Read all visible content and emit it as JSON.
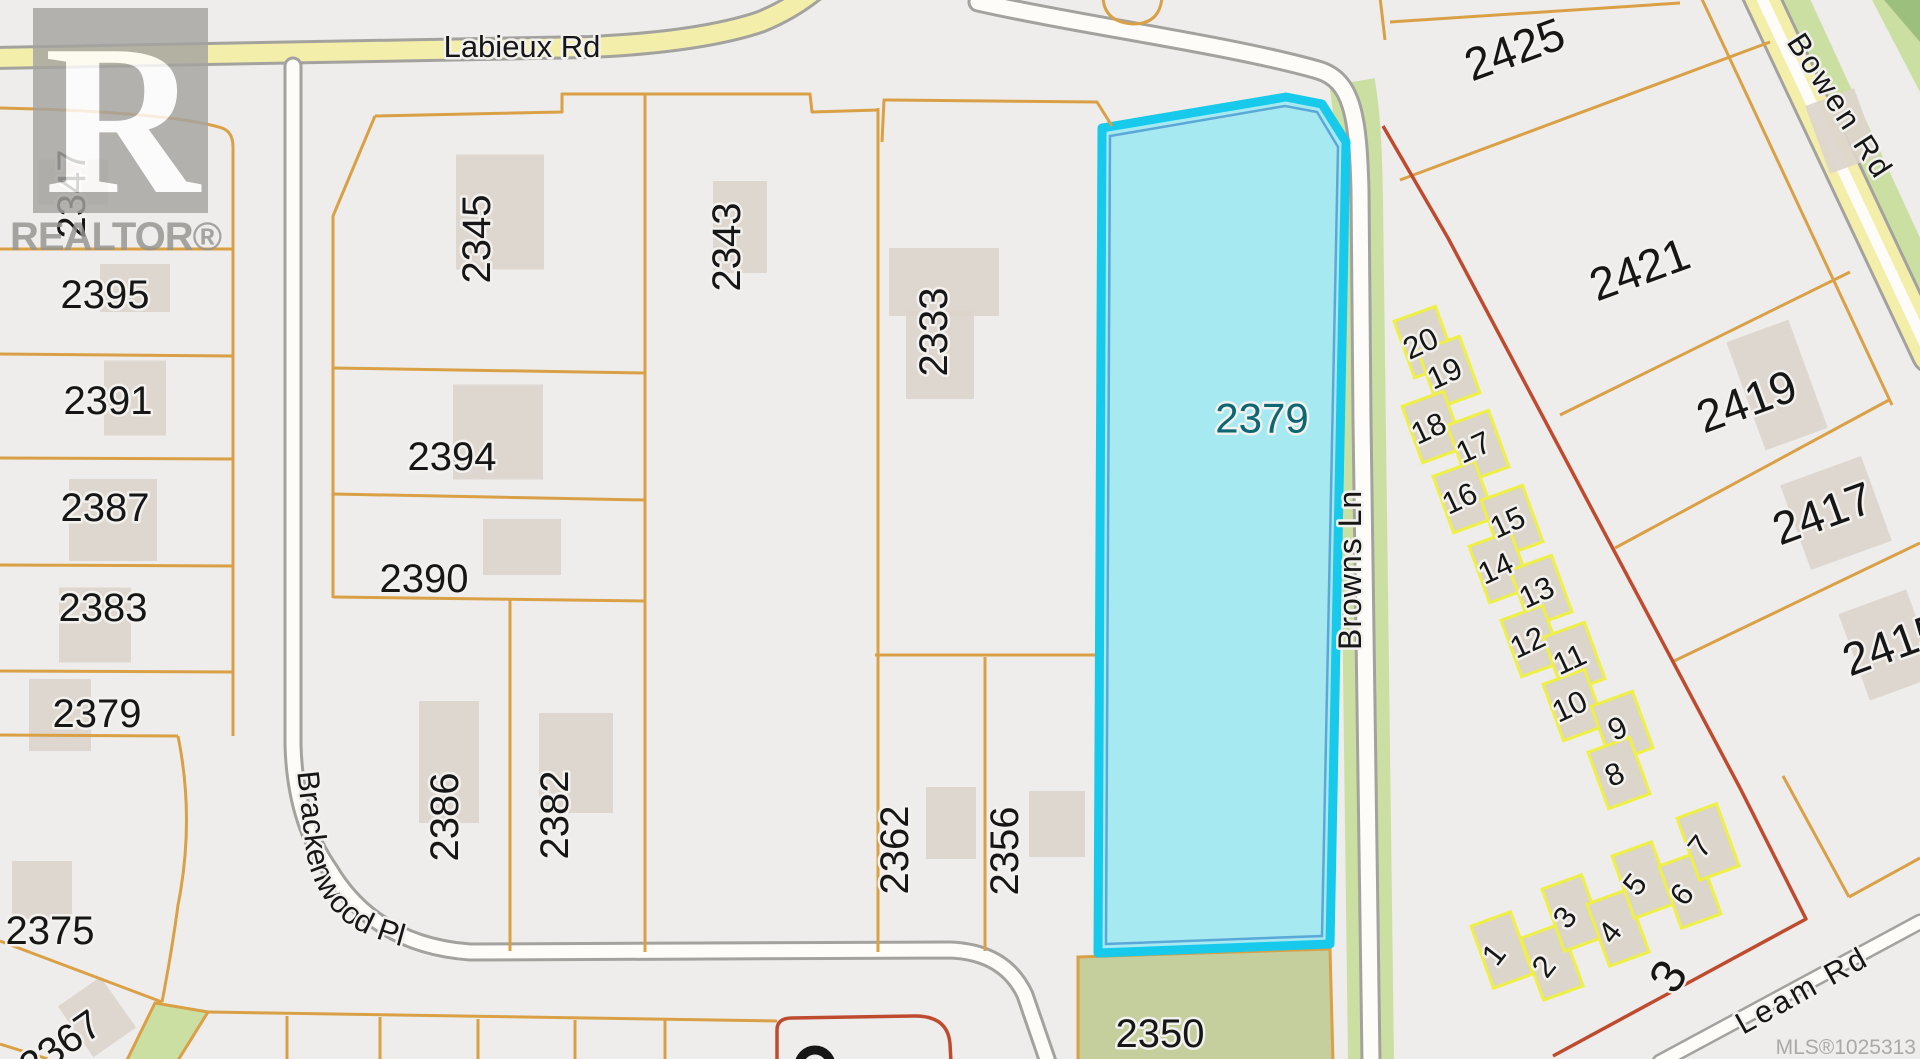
{
  "watermark": {
    "logo_letter": "R",
    "brand": "REALTOR®"
  },
  "mls_number": "MLS®1025313",
  "roads": {
    "labieux": {
      "label": "Labieux Rd"
    },
    "brackenwood": {
      "label": "Brackenwood Pl"
    },
    "browns": {
      "label": "Browns Ln"
    },
    "bowen": {
      "label": "Bowen Rd"
    },
    "leam": {
      "label": "Leam Rd"
    }
  },
  "highlight_parcel": {
    "number": "2379",
    "label_color": "#0c6773"
  },
  "parcel_labels": [
    {
      "t": "2347",
      "x": 85,
      "y": 180,
      "r": -90,
      "s": 40
    },
    {
      "t": "2395",
      "x": 105,
      "y": 294,
      "r": 0,
      "s": 40
    },
    {
      "t": "2391",
      "x": 108,
      "y": 400,
      "r": 0,
      "s": 40
    },
    {
      "t": "2387",
      "x": 105,
      "y": 507,
      "r": 0,
      "s": 40
    },
    {
      "t": "2383",
      "x": 103,
      "y": 607,
      "r": 0,
      "s": 40
    },
    {
      "t": "2379",
      "x": 97,
      "y": 713,
      "r": 0,
      "s": 40
    },
    {
      "t": "2375",
      "x": 50,
      "y": 930,
      "r": 0,
      "s": 40
    },
    {
      "t": "2367",
      "x": 68,
      "y": 1042,
      "r": -35,
      "s": 40
    },
    {
      "t": "2345",
      "x": 490,
      "y": 225,
      "r": -90,
      "s": 40
    },
    {
      "t": "2394",
      "x": 452,
      "y": 456,
      "r": 0,
      "s": 40
    },
    {
      "t": "2390",
      "x": 424,
      "y": 578,
      "r": 0,
      "s": 40
    },
    {
      "t": "2386",
      "x": 458,
      "y": 803,
      "r": -90,
      "s": 40
    },
    {
      "t": "2382",
      "x": 568,
      "y": 801,
      "r": -90,
      "s": 40
    },
    {
      "t": "2343",
      "x": 740,
      "y": 233,
      "r": -90,
      "s": 40
    },
    {
      "t": "2333",
      "x": 947,
      "y": 318,
      "r": -90,
      "s": 40
    },
    {
      "t": "2362",
      "x": 908,
      "y": 836,
      "r": -90,
      "s": 40
    },
    {
      "t": "2356",
      "x": 1018,
      "y": 837,
      "r": -90,
      "s": 40
    },
    {
      "t": "2379",
      "x": 1262,
      "y": 418,
      "r": 0,
      "s": 42,
      "c": "#0c6773"
    },
    {
      "t": "2350",
      "x": 1160,
      "y": 1033,
      "r": 0,
      "s": 40
    },
    {
      "t": "2425",
      "x": 1520,
      "y": 48,
      "r": -20,
      "s": 46
    },
    {
      "t": "2421",
      "x": 1645,
      "y": 268,
      "r": -20,
      "s": 46
    },
    {
      "t": "2419",
      "x": 1752,
      "y": 400,
      "r": -20,
      "s": 46
    },
    {
      "t": "2417",
      "x": 1828,
      "y": 512,
      "r": -20,
      "s": 46
    },
    {
      "t": "2415",
      "x": 1898,
      "y": 643,
      "r": -20,
      "s": 46
    },
    {
      "t": "3",
      "x": 1682,
      "y": 968,
      "r": -58,
      "s": 48
    }
  ],
  "lot_groups": [
    {
      "name": "townhouse-upper-row",
      "w": 44,
      "h": 60,
      "unit_rot": -20,
      "num_rot": -25,
      "num_size": 31,
      "lots": [
        {
          "n": "20",
          "x": 1425,
          "y": 342
        },
        {
          "n": "19",
          "x": 1449,
          "y": 372
        },
        {
          "n": "18",
          "x": 1433,
          "y": 427
        },
        {
          "n": "17",
          "x": 1478,
          "y": 446
        },
        {
          "n": "16",
          "x": 1464,
          "y": 497
        },
        {
          "n": "15",
          "x": 1512,
          "y": 521
        },
        {
          "n": "14",
          "x": 1500,
          "y": 567
        },
        {
          "n": "13",
          "x": 1541,
          "y": 591
        },
        {
          "n": "12",
          "x": 1532,
          "y": 641
        },
        {
          "n": "11",
          "x": 1574,
          "y": 658
        },
        {
          "n": "10",
          "x": 1574,
          "y": 705
        },
        {
          "n": "9",
          "x": 1622,
          "y": 727
        },
        {
          "n": "8",
          "x": 1619,
          "y": 773
        }
      ]
    },
    {
      "name": "townhouse-lower-row",
      "w": 42,
      "h": 66,
      "unit_rot": -20,
      "num_rot": -52,
      "num_size": 31,
      "lots": [
        {
          "n": "1",
          "x": 1502,
          "y": 950
        },
        {
          "n": "2",
          "x": 1552,
          "y": 962
        },
        {
          "n": "3",
          "x": 1573,
          "y": 913
        },
        {
          "n": "4",
          "x": 1618,
          "y": 928
        },
        {
          "n": "5",
          "x": 1643,
          "y": 880
        },
        {
          "n": "6",
          "x": 1690,
          "y": 890
        },
        {
          "n": "7",
          "x": 1708,
          "y": 842
        }
      ]
    }
  ],
  "buildings": [
    [
      73,
      182,
      70,
      45,
      0
    ],
    [
      135,
      288,
      70,
      48,
      0
    ],
    [
      135,
      398,
      62,
      75,
      0
    ],
    [
      113,
      520,
      88,
      82,
      0
    ],
    [
      95,
      625,
      72,
      75,
      0
    ],
    [
      60,
      715,
      62,
      72,
      0
    ],
    [
      42,
      890,
      60,
      58,
      0
    ],
    [
      97,
      1017,
      52,
      62,
      -35
    ],
    [
      500,
      212,
      88,
      115,
      0
    ],
    [
      498,
      432,
      90,
      95,
      0
    ],
    [
      522,
      547,
      78,
      56,
      0
    ],
    [
      449,
      762,
      60,
      122,
      0
    ],
    [
      576,
      763,
      74,
      100,
      0
    ],
    [
      740,
      227,
      54,
      92,
      0
    ],
    [
      944,
      282,
      110,
      68,
      0
    ],
    [
      940,
      355,
      68,
      88,
      0
    ],
    [
      951,
      823,
      50,
      72,
      0
    ],
    [
      1057,
      824,
      56,
      66,
      0
    ],
    [
      1243,
      452,
      68,
      46,
      0,
      "cyan"
    ],
    [
      1777,
      385,
      66,
      115,
      -20
    ],
    [
      1836,
      513,
      86,
      90,
      -20
    ],
    [
      1888,
      645,
      72,
      92,
      -20
    ],
    [
      1842,
      131,
      52,
      72,
      -20
    ]
  ],
  "colors": {
    "bg": "#eeedeb",
    "label_ink": "#161616",
    "halo": "#f2f1ee",
    "line_orange": "#daa046",
    "line_red": "#bf4b2f",
    "lot_outline": "#eef046",
    "building": "#dcd5cc",
    "casing": "#a3a29e",
    "road_white": "#fdfcf9",
    "road_yellow": "#f4eeab",
    "green": "#cbdfa3",
    "green_dark": "#9cbf7d",
    "green_2350": "#c5ce9d",
    "highlight_fill": "#a7e9f0",
    "highlight_border": "#17c9ea",
    "highlight_inner": "#5aa8d8",
    "cyan_building": "#8fd2d8",
    "watermark_gray": "#949390",
    "mls_gray": "#a9a9a9"
  }
}
